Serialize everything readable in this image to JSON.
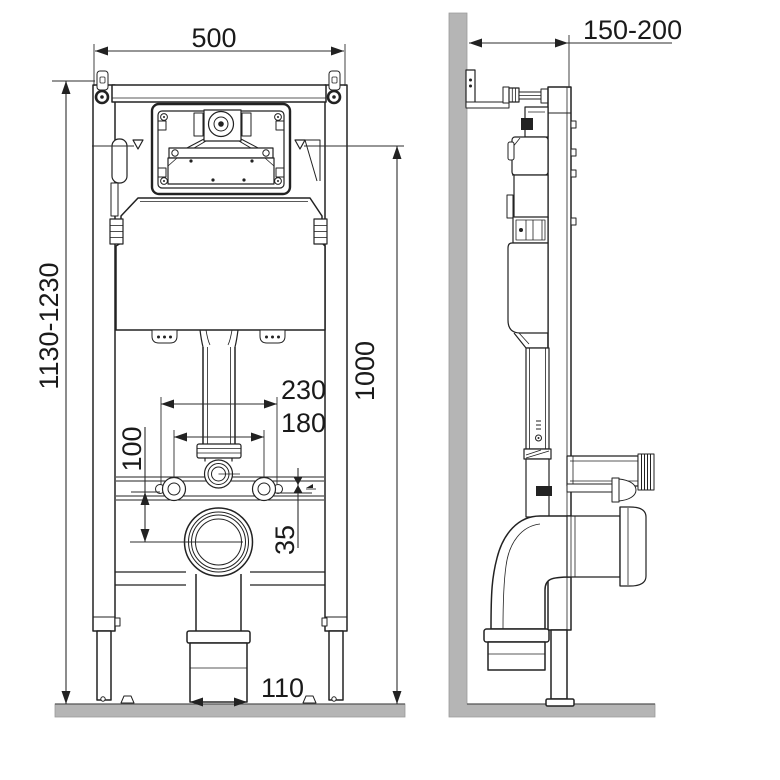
{
  "drawing": {
    "colors": {
      "line": "#222222",
      "wall_fill": "#b5b5b5",
      "background": "#ffffff",
      "text": "#1a1a1a"
    }
  },
  "dimensions": {
    "front": {
      "frame_width": "500",
      "frame_height_range": "1130-1230",
      "flush_axis_height": "1000",
      "fixing_span_outer": "230",
      "fixing_span_inner": "180",
      "stud_to_drain_offset": "100",
      "rail_gap": "35",
      "drain_socket_width": "110"
    },
    "side": {
      "wall_offset_range": "150-200"
    }
  }
}
